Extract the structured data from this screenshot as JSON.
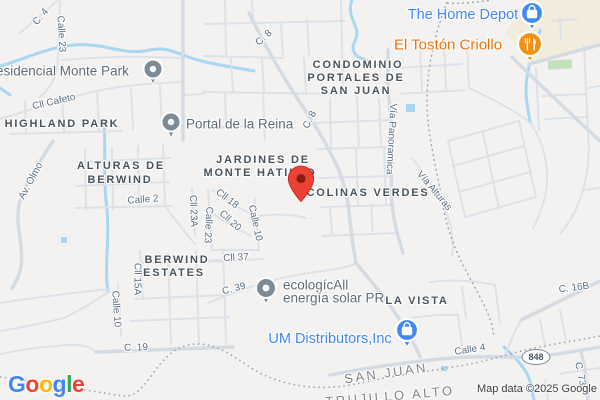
{
  "map_type": "roadmap",
  "attribution": "Map data ©2025 Google",
  "logo": [
    "G",
    "o",
    "o",
    "g",
    "l",
    "e"
  ],
  "marker": {
    "name": "destination-pin",
    "color": "#EA4335"
  },
  "neighborhoods": {
    "highland_park": "HIGHLAND PARK",
    "alturas_line1": "ALTURAS DE",
    "alturas_line2": "BERWIND",
    "jardines_line1": "JARDINES DE",
    "jardines_line2": "MONTE HATILLO",
    "colinas_verdes": "COLINAS VERDES",
    "condominio_line1": "CONDOMINIO",
    "condominio_line2": "PORTALES DE",
    "condominio_line3": "SAN JUAN",
    "berwind_line1": "BERWIND",
    "berwind_line2": "ESTATES",
    "la_vista": "LA VISTA"
  },
  "cities": {
    "san_juan": "SAN JUAN",
    "trujillo_alto": "TRUJILLO ALTO"
  },
  "businesses": {
    "home_depot": {
      "label": "The Home Depot",
      "icon": "shopping-bag-pin",
      "color": "#4285F4"
    },
    "el_toston": {
      "label": "El Tostón Criollo",
      "icon": "restaurant-fork-knife-pin",
      "color": "#E8710A"
    },
    "um_distributors": {
      "label": "UM Distributors,Inc",
      "icon": "shopping-bag-pin",
      "color": "#4285F4"
    },
    "ecologic_line1": "ecologícAll",
    "ecologic_line2": "energía solar PR",
    "portal_reina": {
      "label": "Portal de la Reina",
      "icon": "generic-poi-pin"
    },
    "monte_park": {
      "label": "esidencial Monte Park",
      "icon": "generic-poi-pin"
    }
  },
  "roads": {
    "c4": "C. 4",
    "calle23_top": "Calle 23",
    "cll_cafeto": "Cll Cafeto",
    "c8_a": "C. 8",
    "c8_b": "C. 8",
    "av_olmo": "Av. Olmo",
    "calle2": "Calle 2",
    "cll23a": "Cll 23A",
    "calle23_mid": "Calle 23",
    "cll18": "Cll 18",
    "cll20": "Cll 20",
    "calle10_mid": "Calle 10",
    "cll37": "Cll 37",
    "cll15a": "Cll 15A",
    "calle10_bottom": "Calle 10",
    "c19": "C. 19",
    "c39": "C. 39",
    "via_panoramica": "Vía Panoramica",
    "via_alturas": "Vía Alturas",
    "calle4": "Calle 4",
    "c16b": "C. 16B",
    "c73": "C. 73",
    "route_shield": "848"
  },
  "colors": {
    "land": "#f3f2f0",
    "road_minor": "#dde2e8",
    "road_major": "#d4dbe2",
    "water": "#a7d7f2",
    "commercial_area": "#f2ecdc",
    "park_green": "#c3e2bc",
    "boundary": "#9aa0a6",
    "marker_red": "#EA4335",
    "poi_pin_gray": "#7c8b98",
    "business_pin_blue": "#4089F8",
    "business_pin_orange": "#F29111"
  }
}
